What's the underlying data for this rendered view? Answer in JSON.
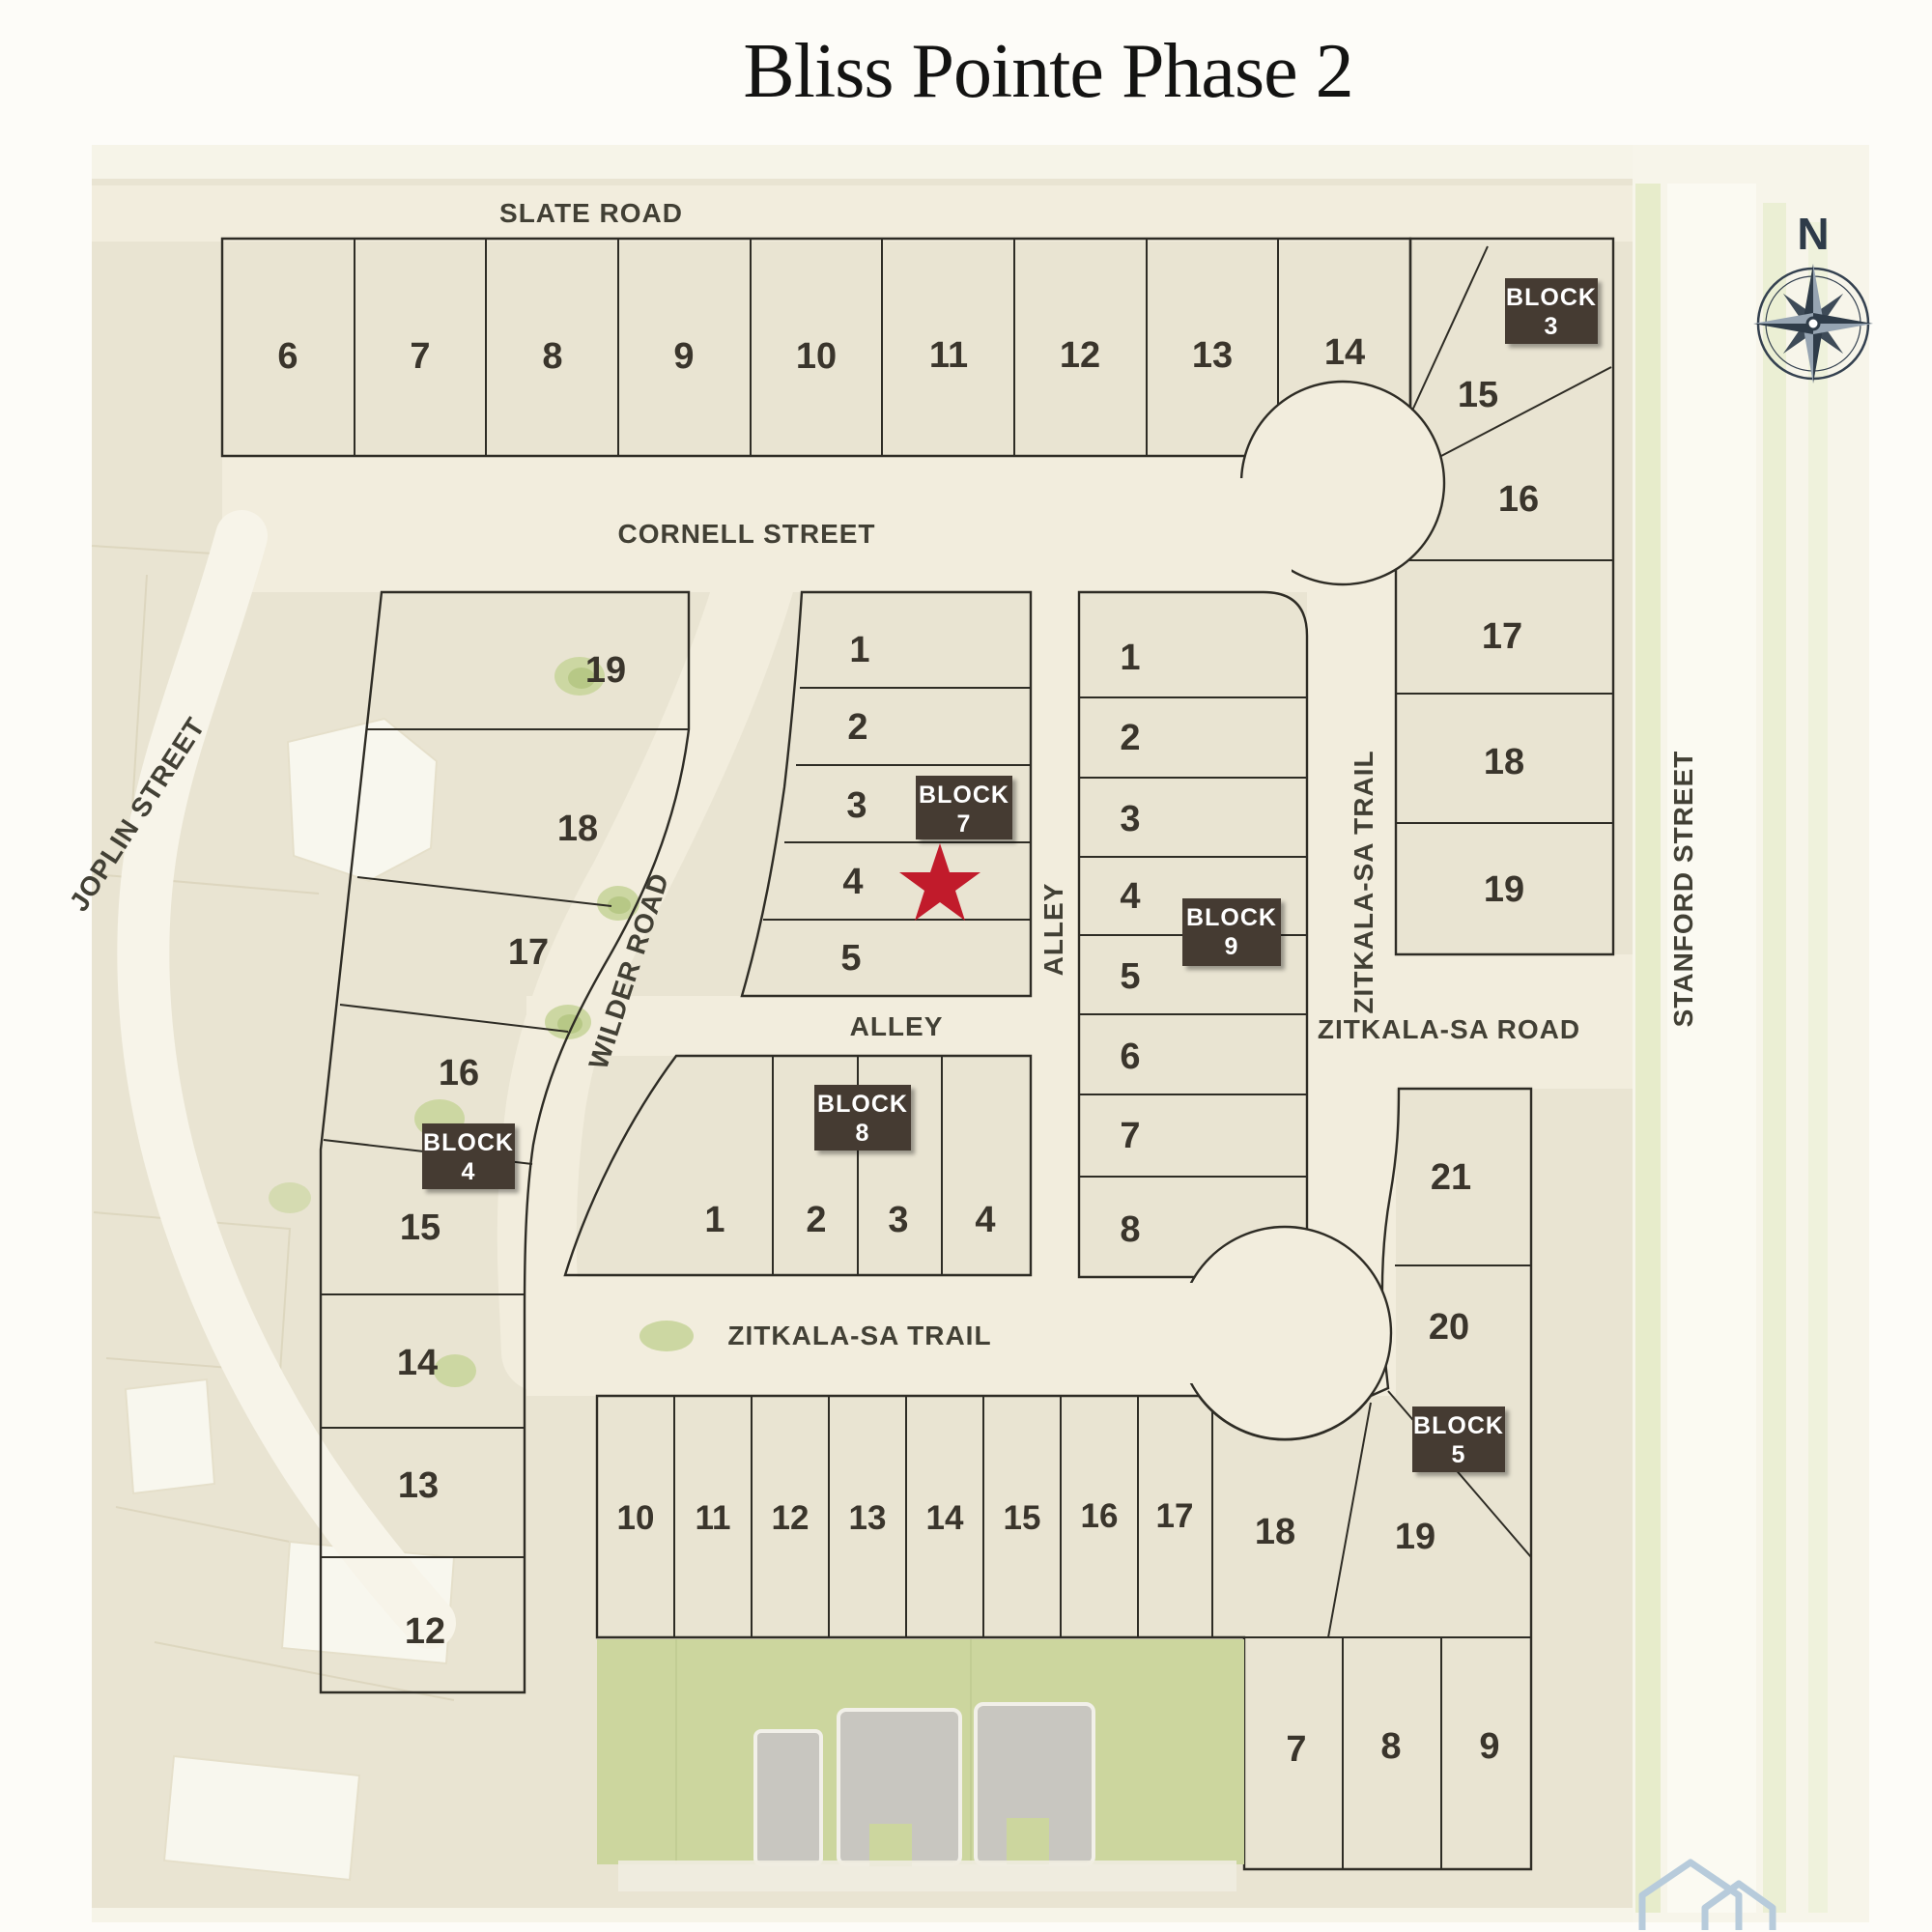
{
  "title": "Bliss Pointe Phase 2",
  "compass": {
    "north_label": "N"
  },
  "streets": {
    "slate": "SLATE ROAD",
    "cornell": "CORNELL STREET",
    "joplin": "JOPLIN STREET",
    "wilder": "WILDER ROAD",
    "alley_horizontal": "ALLEY",
    "alley_vertical": "ALLEY",
    "zitkala_trail_vertical": "ZITKALA-SA TRAIL",
    "zitkala_road": "ZITKALA-SA ROAD",
    "zitkala_trail_horizontal": "ZITKALA-SA TRAIL",
    "stanford": "STANFORD STREET"
  },
  "blocks": {
    "block3": {
      "label_line1": "BLOCK",
      "label_line2": "3",
      "lots": [
        "6",
        "7",
        "8",
        "9",
        "10",
        "11",
        "12",
        "13",
        "14",
        "15",
        "16",
        "17",
        "18",
        "19"
      ]
    },
    "block4": {
      "label_line1": "BLOCK",
      "label_line2": "4",
      "lots": [
        "19",
        "18",
        "17",
        "16",
        "15",
        "14",
        "13",
        "12"
      ]
    },
    "block5": {
      "label_line1": "BLOCK",
      "label_line2": "5",
      "lots": [
        "10",
        "11",
        "12",
        "13",
        "14",
        "15",
        "16",
        "17",
        "18",
        "19",
        "20",
        "21",
        "7",
        "8",
        "9"
      ]
    },
    "block7": {
      "label_line1": "BLOCK",
      "label_line2": "7",
      "lots": [
        "1",
        "2",
        "3",
        "4",
        "5"
      ]
    },
    "block8": {
      "label_line1": "BLOCK",
      "label_line2": "8",
      "lots": [
        "1",
        "2",
        "3",
        "4"
      ]
    },
    "block9": {
      "label_line1": "BLOCK",
      "label_line2": "9",
      "lots": [
        "1",
        "2",
        "3",
        "4",
        "5",
        "6",
        "7",
        "8"
      ]
    }
  },
  "marker": {
    "shape": "star",
    "color": "#c11b2b"
  },
  "colors": {
    "block3": "#6fb6a4",
    "block4": "#c9c3ad",
    "block5": "#ce9b5e",
    "block7": "#dd6a57",
    "block8": "#7caecb",
    "block9": "#a7ca40",
    "road": "#f2eddd",
    "field": "#e9e4d2",
    "label_box": "#453b33",
    "star": "#c11b2b",
    "compass": "#344150"
  }
}
